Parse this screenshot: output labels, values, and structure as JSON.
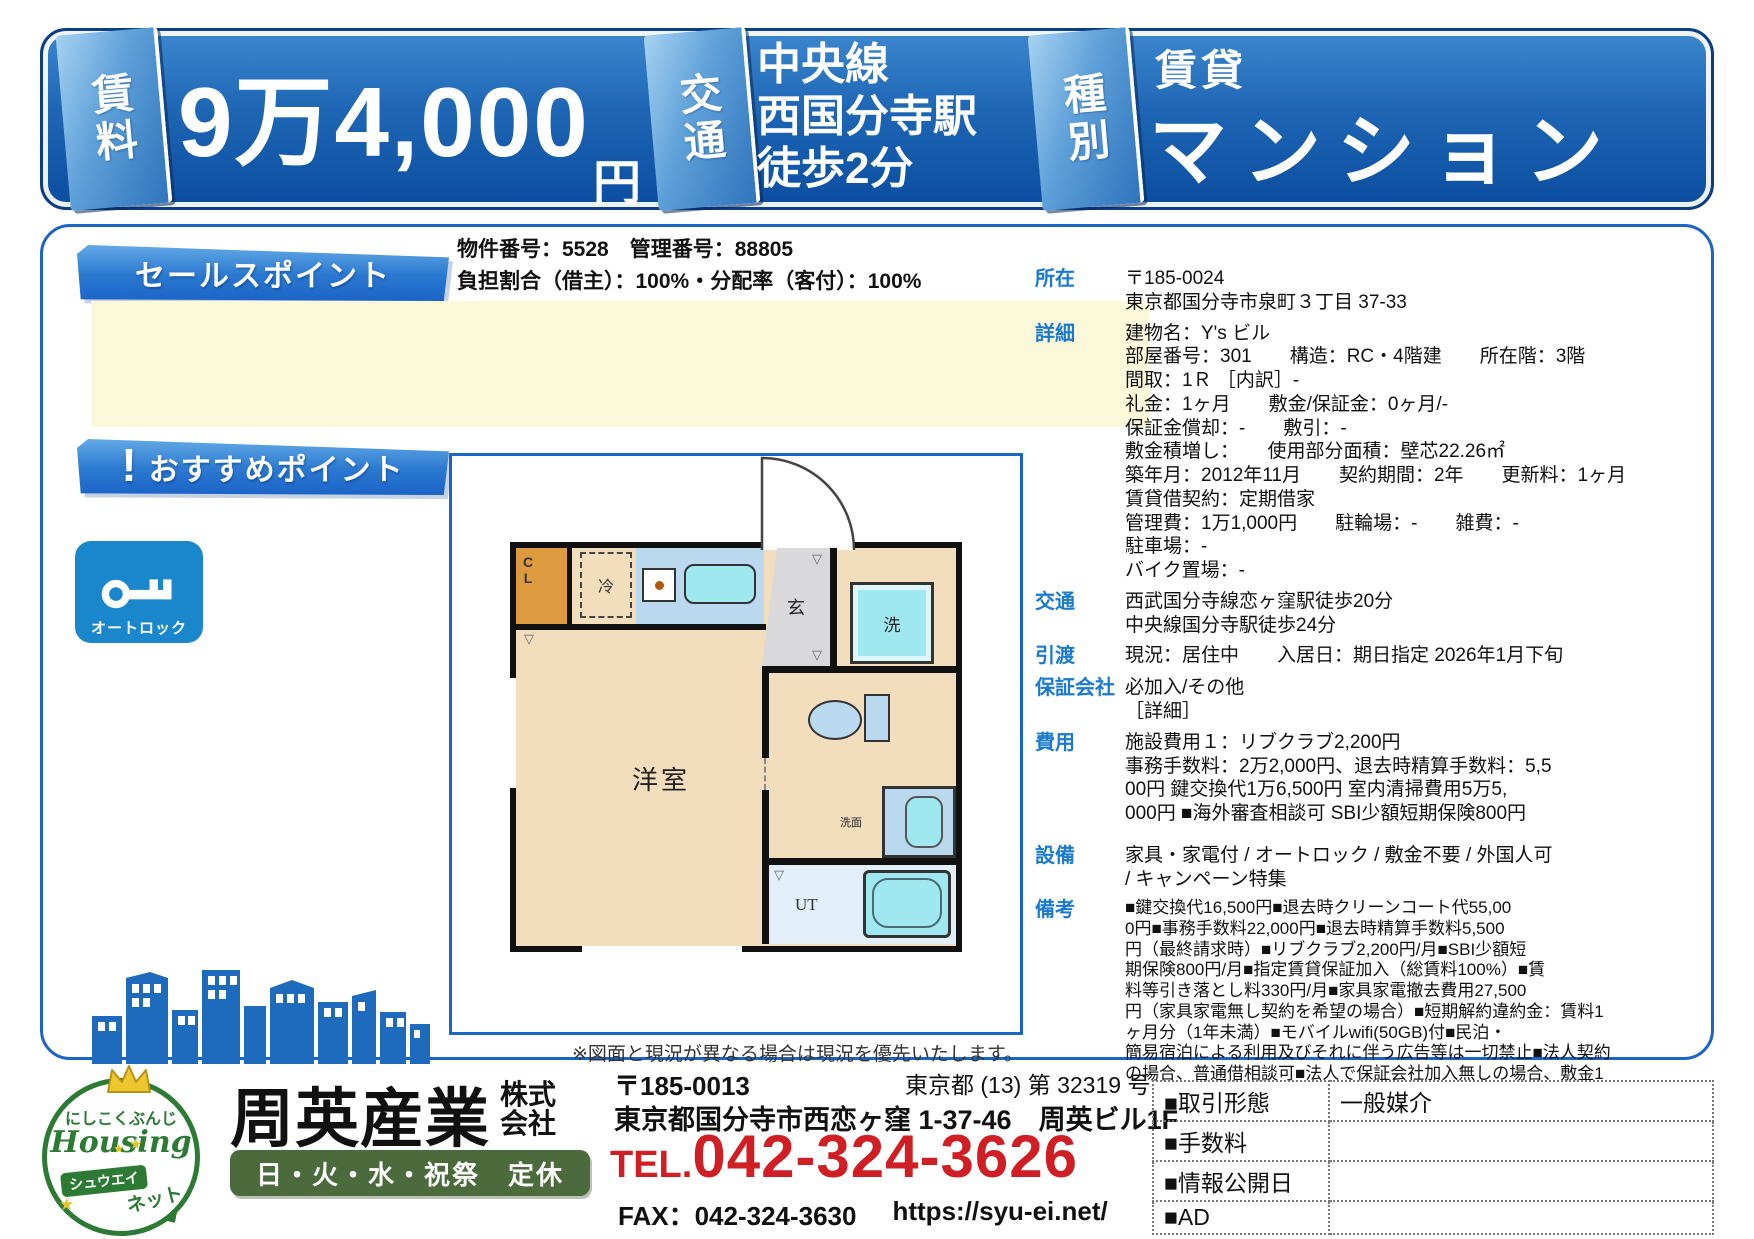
{
  "banner": {
    "rent": {
      "tab": "賃料",
      "value": "9万4,000",
      "unit": "円"
    },
    "access": {
      "tab": "交通",
      "lines": [
        "中央線",
        "西国分寺駅",
        "徒歩2分"
      ]
    },
    "type": {
      "tab": "種別",
      "category": "賃貸",
      "kind": "マンション"
    }
  },
  "meta": {
    "property_line": "物件番号：5528　管理番号：88805",
    "ratio_line": "負担割合（借主）：100%・分配率（客付）：100%"
  },
  "ribbons": {
    "sales": "セールスポイント",
    "recommend": "おすすめポイント",
    "recommend_mark": "!"
  },
  "badges": {
    "autolock": "オートロック"
  },
  "floorplan": {
    "caption": "※図面と現況が異なる場合は現況を優先いたします。",
    "rooms": {
      "closet": "CL",
      "fridge": "冷",
      "entrance": "玄",
      "washer": "洗",
      "basin": "洗面",
      "utility": "UT",
      "main": "洋室"
    }
  },
  "details": [
    {
      "label": "所在",
      "lines": [
        "〒185-0024",
        "東京都国分寺市泉町３丁目 37-33"
      ]
    },
    {
      "label": "詳細",
      "lines": [
        "建物名：Y's ビル",
        "部屋番号：301　　構造：RC・4階建　　所在階：3階",
        "間取：1Ｒ ［内訳］-",
        "礼金：1ヶ月　　敷金/保証金：0ヶ月/-",
        "保証金償却：-　　敷引：-",
        "敷金積増し：　　使用部分面積：壁芯22.26㎡",
        "築年月：2012年11月　　契約期間：2年　　更新料：1ヶ月",
        "賃貸借契約：定期借家",
        "管理費：1万1,000円　　駐輪場：-　　雑費：-",
        "駐車場：-",
        "バイク置場：-"
      ]
    },
    {
      "label": "交通",
      "lines": [
        "西武国分寺線恋ヶ窪駅徒歩20分",
        "中央線国分寺駅徒歩24分"
      ]
    },
    {
      "label": "引渡",
      "lines": [
        "現況：居住中　　入居日：期日指定 2026年1月下旬"
      ]
    },
    {
      "label": "保証会社",
      "lines": [
        "必加入/その他",
        "［詳細］"
      ]
    },
    {
      "label": "費用",
      "lines": [
        "施設費用１：リブクラブ2,200円",
        "事務手数料：2万2,000円、退去時精算手数料：5,5",
        "00円 鍵交換代1万6,500円 室内清掃費用5万5,",
        "000円 ■海外審査相談可 SBI少額短期保険800円"
      ]
    },
    {
      "label": "設備",
      "lines": [
        "家具・家電付 / オートロック / 敷金不要 / 外国人可",
        "/ キャンペーン特集"
      ]
    },
    {
      "label": "備考",
      "lines": [
        "■鍵交換代16,500円■退去時クリーンコート代55,00",
        "0円■事務手数料22,000円■退去時精算手数料5,500",
        "円（最終請求時）■リブクラブ2,200円/月■SBI少額短",
        "期保険800円/月■指定賃貸保証加入（総賃料100%）■賃",
        "料等引き落とし料330円/月■家具家電撤去費用27,500",
        "円（家具家電無し契約を希望の場合）■短期解約違約金：賃料1",
        "ヶ月分（1年未満）■モバイルwifi(50GB)付■民泊・",
        "簡易宿泊による利用及びそれに伴う広告等は一切禁止■法人契約",
        "の場合、普通借相談可■法人で保証会社加入無しの場合、敷金1"
      ]
    }
  ],
  "footer": {
    "logo": {
      "top": "にしこくぶんじ",
      "brand": "Housing",
      "badge": "シュウエイ",
      "bottom": "ネット"
    },
    "company": {
      "name": "周英産業",
      "suffix": [
        "株式",
        "会社"
      ],
      "closed": "日・火・水・祝祭　定休"
    },
    "contact": {
      "postal": "〒185-0013",
      "address": "東京都国分寺市西恋ヶ窪 1-37-46　周英ビル1F",
      "tel_label": "TEL.",
      "tel": "042-324-3626",
      "fax": "FAX：042-324-3630",
      "url": "https://syu-ei.net/",
      "license": "東京都 (13) 第 32319 号"
    },
    "table": {
      "rows": [
        {
          "label": "■取引形態",
          "value": "一般媒介"
        },
        {
          "label": "■手数料",
          "value": ""
        },
        {
          "label": "■情報公開日",
          "value": ""
        },
        {
          "label": "■AD",
          "value": ""
        }
      ]
    }
  },
  "colors": {
    "banner_blue": "#0b4da0",
    "accent_blue": "#1b64c8",
    "label_blue": "#1a7ad2",
    "tel_red": "#cf1f25",
    "logo_green": "#2c7a33",
    "closed_green": "#4c6b3c",
    "highlight_yellow": "#fcf8da"
  }
}
